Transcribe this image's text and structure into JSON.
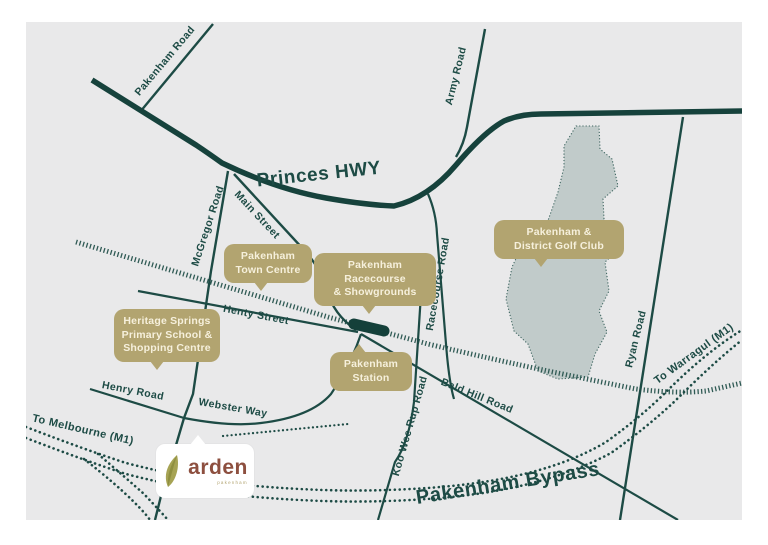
{
  "map": {
    "road_labels": [
      {
        "id": "pakenham-road",
        "text": "Pakenham Road"
      },
      {
        "id": "princes-hwy",
        "text": "Princes HWY"
      },
      {
        "id": "army-road",
        "text": "Army Road"
      },
      {
        "id": "mcgregor-road",
        "text": "McGregor Road"
      },
      {
        "id": "main-street",
        "text": "Main Street"
      },
      {
        "id": "racecourse-road",
        "text": "Racecourse Road"
      },
      {
        "id": "henty-street",
        "text": "Henty Street"
      },
      {
        "id": "henry-road",
        "text": "Henry Road"
      },
      {
        "id": "webster-way",
        "text": "Webster Way"
      },
      {
        "id": "bald-hill-road",
        "text": "Bald Hill Road"
      },
      {
        "id": "koo-wee-rup-road",
        "text": "Koo Wee Rup Road"
      },
      {
        "id": "ryan-road",
        "text": "Ryan Road"
      },
      {
        "id": "to-melbourne",
        "text": "To Melbourne (M1)"
      },
      {
        "id": "to-warragul",
        "text": "To Warragul (M1)"
      },
      {
        "id": "pakenham-bypass",
        "text": "Pakenham Bypass"
      }
    ],
    "callouts": [
      {
        "id": "pakenham-town-centre",
        "lines": [
          "Pakenham",
          "Town Centre"
        ]
      },
      {
        "id": "pakenham-racecourse",
        "lines": [
          "Pakenham Racecourse",
          "& Showgrounds"
        ]
      },
      {
        "id": "golf-club",
        "lines": [
          "Pakenham &",
          "District Golf Club"
        ]
      },
      {
        "id": "heritage-springs",
        "lines": [
          "Heritage Springs",
          "Primary School &",
          "Shopping Centre"
        ]
      },
      {
        "id": "pakenham-station",
        "lines": [
          "Pakenham",
          "Station"
        ]
      }
    ],
    "logo": {
      "name": "arden",
      "tagline": "pakenham"
    },
    "colors": {
      "map_background": "#e9e9ea",
      "road": "#1d4b45",
      "highway": "#16423c",
      "railway": "#2f5a54",
      "callout": "#b2a470",
      "callout_text": "#f6f0dc",
      "golf_fill": "#c1cbca",
      "logo_text": "#8d4f3f",
      "leaf": "#a6a354"
    }
  }
}
